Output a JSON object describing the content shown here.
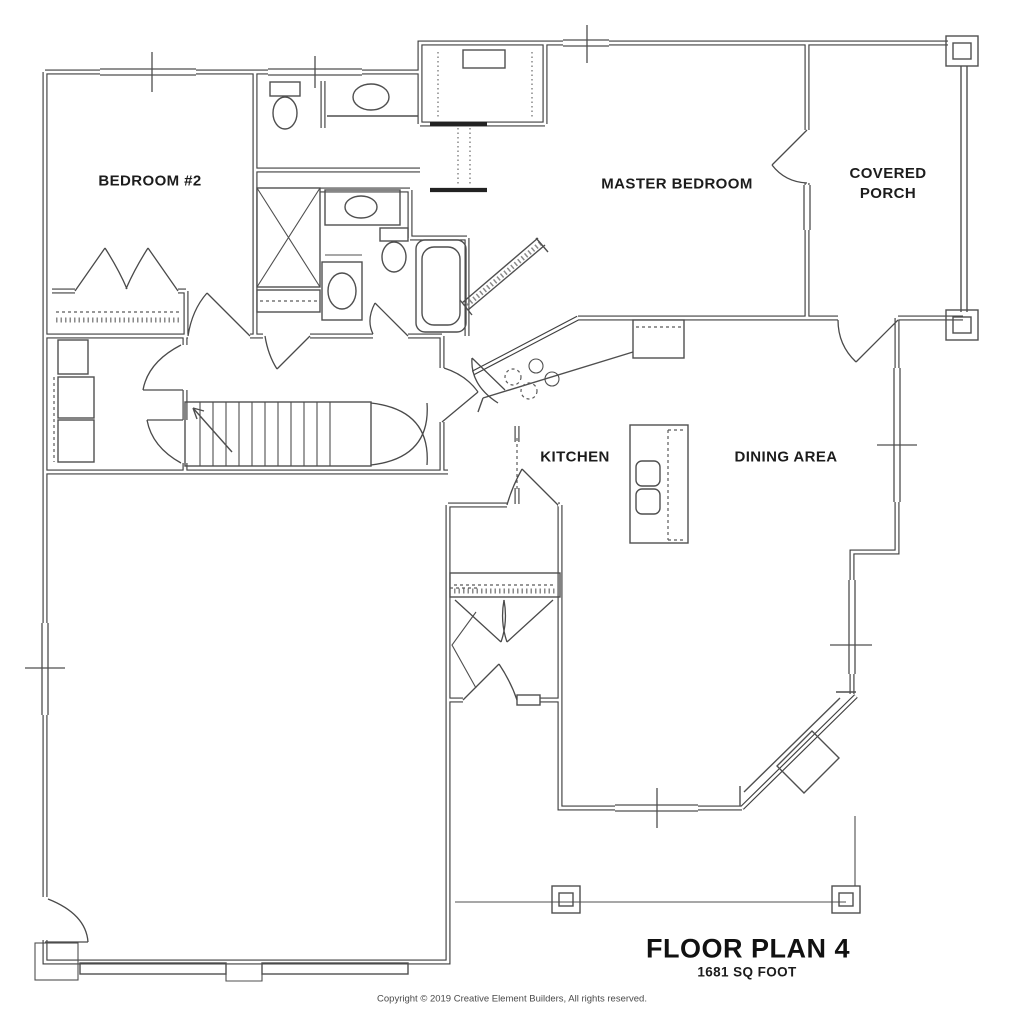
{
  "plan": {
    "title": "FLOOR PLAN 4",
    "subtitle": "1681 SQ FOOT",
    "copyright": "Copyright © 2019 Creative Element Builders, All rights reserved."
  },
  "rooms": {
    "bedroom2": "BEDROOM #2",
    "master_bedroom": "MASTER BEDROOM",
    "covered_porch": "COVERED PORCH",
    "kitchen": "KITCHEN",
    "dining_area": "DINING AREA"
  },
  "colors": {
    "wall_line": "#3f3f3f",
    "fixture_line": "#4f4f4f",
    "label_text": "#1c1c1c",
    "background": "#ffffff"
  }
}
